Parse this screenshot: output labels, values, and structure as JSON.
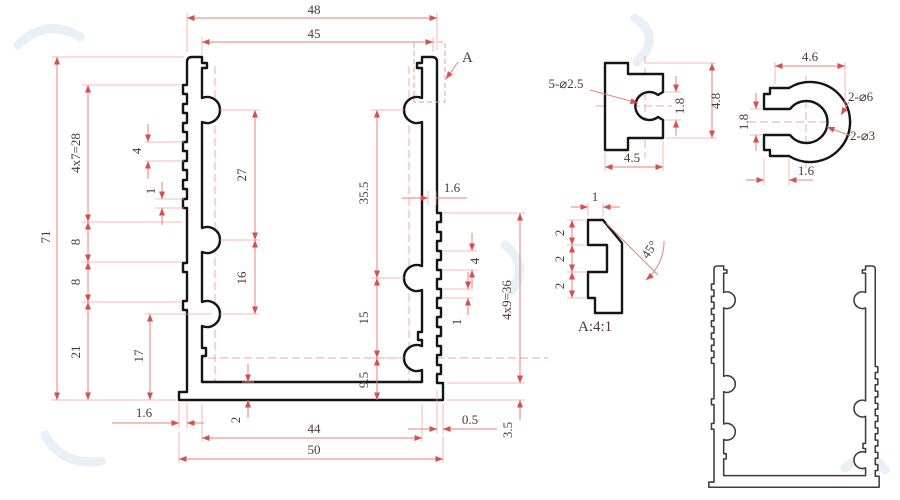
{
  "colors": {
    "dimension_line": "#e8807e",
    "extension_line": "#f2a5a3",
    "arrow": "#d94f4f",
    "dimension_text": "#4e3935",
    "profile_outline": "#151515",
    "secondary_profile_outline": "#3d3d3d",
    "centerline": "#f2a0a0",
    "watermark": "#d9e6f1"
  },
  "main_view": {
    "dims": {
      "width_overall": "48",
      "width_inner_top": "45",
      "height_overall": "71",
      "rib_pitch_left": "4x7=28",
      "rib_pitch_small_left": "4",
      "rib_height_left": "1",
      "spacing_8a": "8",
      "spacing_8b": "8",
      "bottom_left_21": "21",
      "bottom_left_17": "17",
      "boss_spacing_27": "27",
      "boss_spacing_16": "16",
      "right_35_5": "35.5",
      "right_15": "15",
      "right_9_5": "9.5",
      "wall_1_6": "1.6",
      "rib_pitch_small_right": "4",
      "rib_height_right": "1",
      "rib_pitch_right": "4x9=36",
      "lip_0_5": "0.5",
      "base_3_5": "3.5",
      "base_1_6": "1.6",
      "base_2": "2",
      "width_inner_bottom": "44",
      "width_base": "50"
    },
    "detail_callout": "A"
  },
  "detail_slot": {
    "holes": "5-⌀2.5",
    "slot_width": "1.8",
    "height": "4.8",
    "width": "4.5"
  },
  "detail_ring": {
    "width": "4.6",
    "slot_width": "1.8",
    "tab_width": "1.6",
    "outer_holes": "2-⌀6",
    "inner_holes": "2-⌀3"
  },
  "detail_a": {
    "top_width": "1",
    "step_a": "2",
    "step_b": "2",
    "step_c": "2",
    "angle": "45°",
    "label": "A:4:1"
  }
}
